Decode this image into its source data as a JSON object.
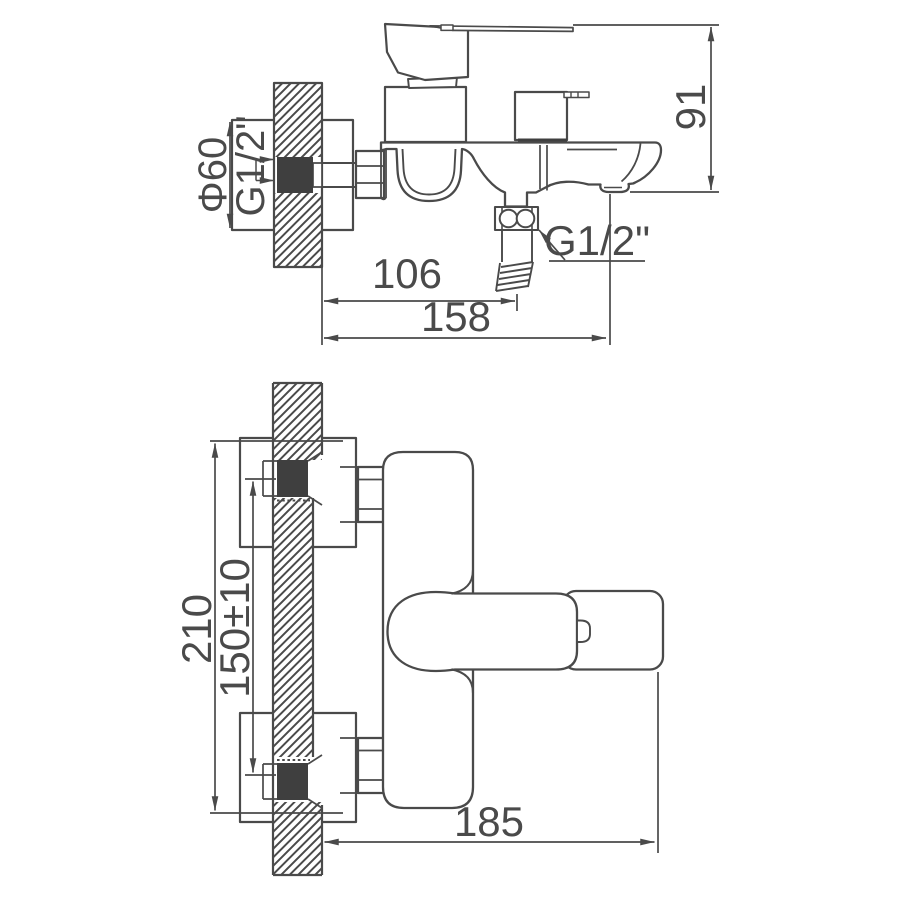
{
  "drawing": {
    "title": "Wall-mounted bath mixer faucet installation drawing",
    "colors": {
      "line": "#4a4a4a",
      "dark_fill": "#3f3f3f",
      "background": "#ffffff"
    },
    "side_view": {
      "name": "side view with wall cross-section",
      "dims": {
        "phi60": "Φ60",
        "g12_inlet": "G1/2\"",
        "g12_shower": "G1/2\"",
        "height_91": "91",
        "width_106": "106",
        "width_158": "158"
      }
    },
    "front_view": {
      "name": "front view with wall cross-section",
      "dims": {
        "height_210": "210",
        "spacing_150": "150±10",
        "width_185": "185"
      }
    }
  }
}
